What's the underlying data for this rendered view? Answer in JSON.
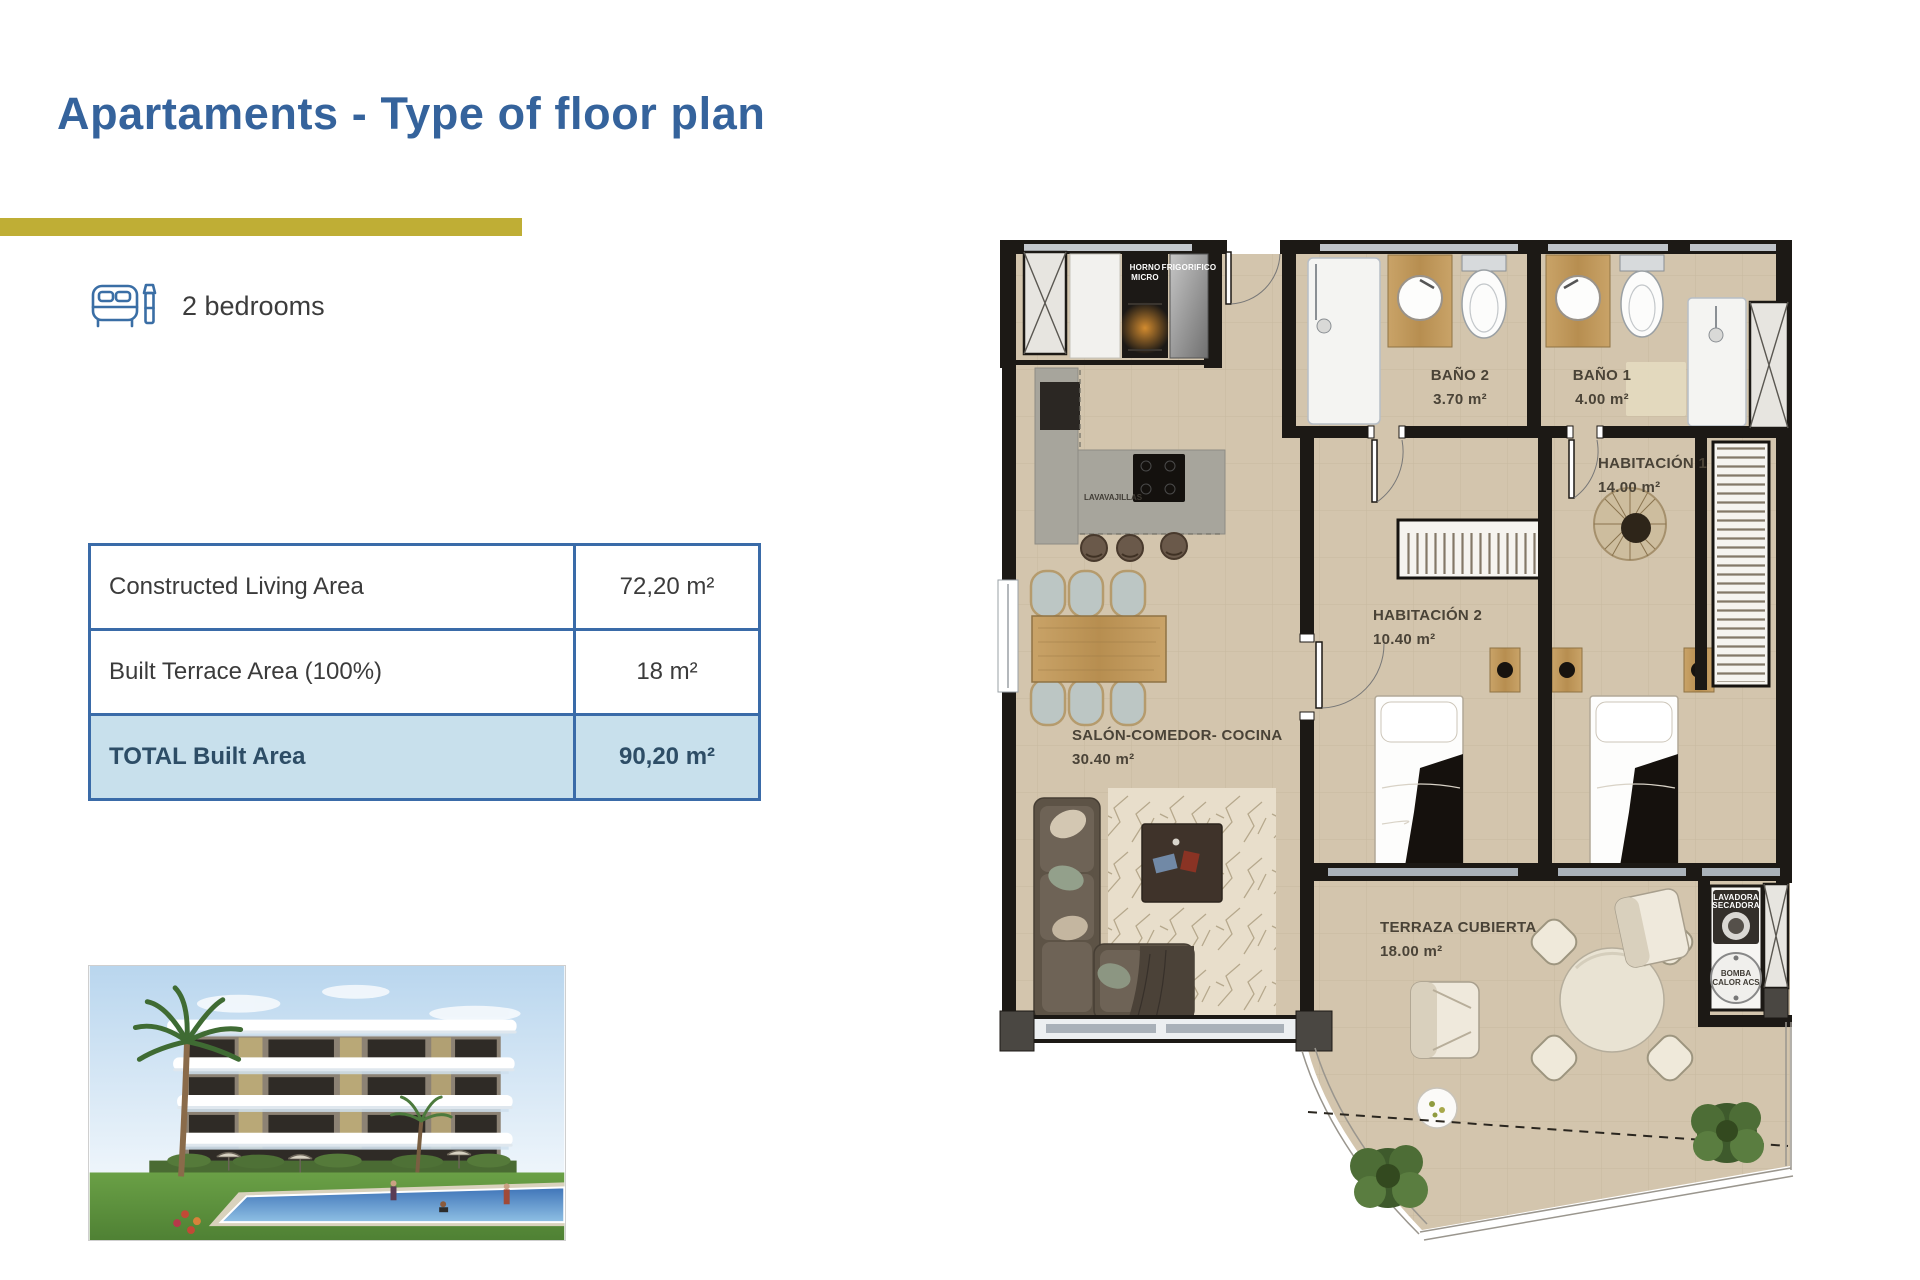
{
  "page": {
    "title": "Apartaments - Type of floor plan"
  },
  "bedrooms": {
    "label": "2 bedrooms"
  },
  "area_table": {
    "rows": [
      {
        "label": "Constructed Living Area",
        "value": "72,20 m²",
        "highlight": false
      },
      {
        "label": "Built Terrace Area (100%)",
        "value": "18 m²",
        "highlight": false
      },
      {
        "label": "TOTAL Built Area",
        "value": "90,20 m²",
        "highlight": true
      }
    ]
  },
  "floor_plan": {
    "rooms": {
      "bano2": {
        "name": "BAÑO 2",
        "area": "3.70 m²"
      },
      "bano1": {
        "name": "BAÑO 1",
        "area": "4.00 m²"
      },
      "hab1": {
        "name": "HABITACIÓN 1",
        "area": "14.00 m²"
      },
      "hab2": {
        "name": "HABITACIÓN 2",
        "area": "10.40 m²"
      },
      "salon": {
        "name": "SALÓN-COMEDOR- COCINA",
        "area": "30.40 m²"
      },
      "terraza": {
        "name": "TERRAZA CUBIERTA",
        "area": "18.00 m²"
      }
    },
    "appliances": {
      "oven": {
        "line1": "HORNO",
        "line2": "MICRO"
      },
      "fridge": {
        "label": "FRIGORIFICO"
      },
      "dishwasher": {
        "label": "LAVAVAJILLAS"
      },
      "washer": {
        "line1": "LAVADORA",
        "line2": "SECADORA"
      },
      "heat_pump": {
        "line1": "BOMBA",
        "line2": "CALOR ACS"
      }
    }
  },
  "colors": {
    "title_blue": "#35639C",
    "accent_yellow": "#BFAE35",
    "table_border": "#3A6BA8",
    "highlight_row_bg": "#C8E0EC",
    "plan_floor_beige": "#D3C5AD",
    "plan_wall_black": "#1C1915"
  }
}
